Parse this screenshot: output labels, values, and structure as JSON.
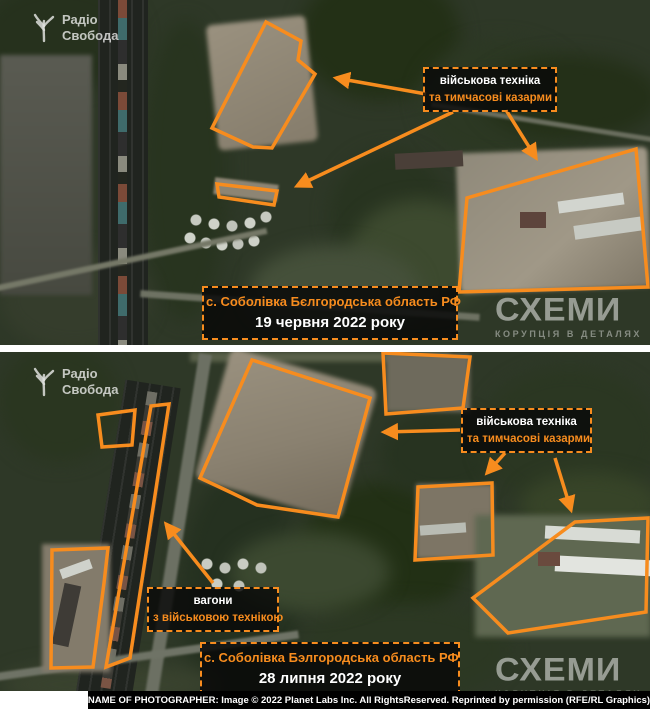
{
  "accent_color": "#F78C1E",
  "panel_top": {
    "logo": {
      "line1": "Радіо",
      "line2": "Свобода"
    },
    "equipment_label": {
      "line1": "військова техніка",
      "line2": "та тимчасові казарми"
    },
    "caption": {
      "location": "с. Соболівка Бєлгородська область РФ",
      "date": "19 червня 2022 року"
    },
    "watermark": {
      "brand": "СХЕМИ",
      "tagline": "КОРУПЦІЯ В ДЕТАЛЯХ"
    }
  },
  "panel_bottom": {
    "logo": {
      "line1": "Радіо",
      "line2": "Свобода"
    },
    "equipment_label": {
      "line1": "військова техніка",
      "line2": "та тимчасові казарми"
    },
    "wagons_label": {
      "line1": "вагони",
      "line2": "з військовою технікою"
    },
    "caption": {
      "location": "с. Соболівка Бэлгородська область РФ",
      "date": "28 липня 2022 року"
    },
    "watermark": {
      "brand": "СХЕМИ",
      "tagline": "КОРУПЦІЯ В ДЕТАЛЯХ"
    }
  },
  "credit_bar": {
    "text": "NAME OF PHOTOGRAPHER: Image © 2022 Planet Labs Inc. All RightsReserved. Reprinted by permission (RFE/RL Graphics)"
  }
}
